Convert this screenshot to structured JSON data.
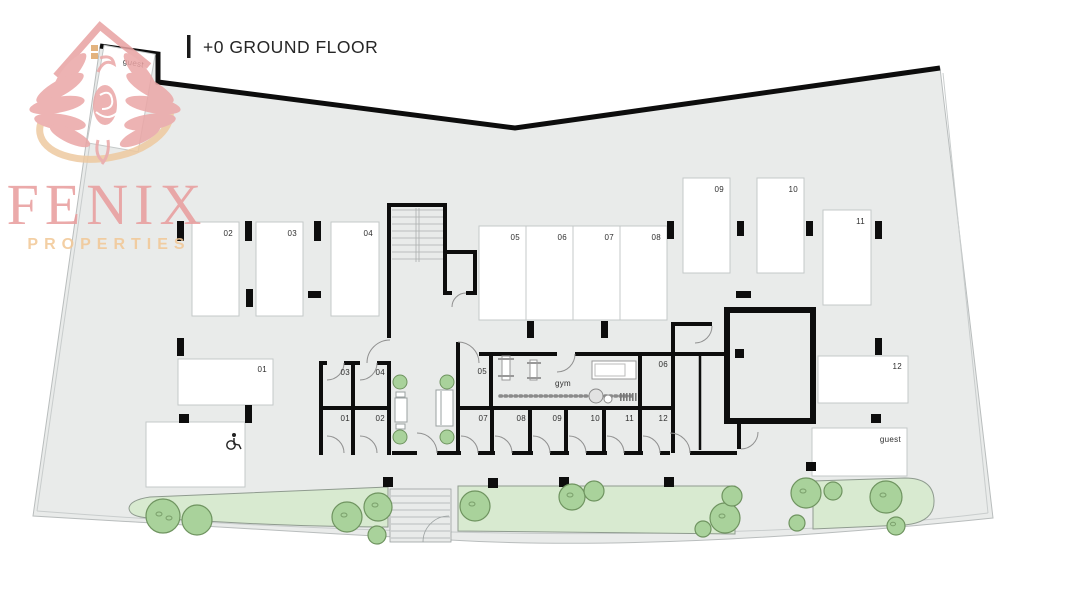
{
  "header": {
    "floor_label": "+0 GROUND FLOOR"
  },
  "logo": {
    "brand": "FENIX",
    "tagline": "PROPERTIES"
  },
  "colors": {
    "site_fill": "#e9ebea",
    "boundary_wall": "#0d0d0d",
    "green_strip": "#d8ead0",
    "bush": "#a9d29b",
    "logo_pink": "#e89c9c",
    "logo_orange": "#f2c795"
  },
  "parking": {
    "p01": "01",
    "p02": "02",
    "p03": "03",
    "p04": "04",
    "p05": "05",
    "p06": "06",
    "p07": "07",
    "p08": "08",
    "p09": "09",
    "p10": "10",
    "p11": "11",
    "p12": "12",
    "guest_top_left": "guest",
    "guest_bottom_right": "guest"
  },
  "storage": {
    "s01": "01",
    "s02": "02",
    "s03": "03",
    "s04": "04",
    "s05": "05",
    "s06": "06",
    "s07": "07",
    "s08": "08",
    "s09": "09",
    "s10": "10",
    "s11": "11",
    "s12": "12"
  },
  "gym": {
    "label": "gym"
  }
}
